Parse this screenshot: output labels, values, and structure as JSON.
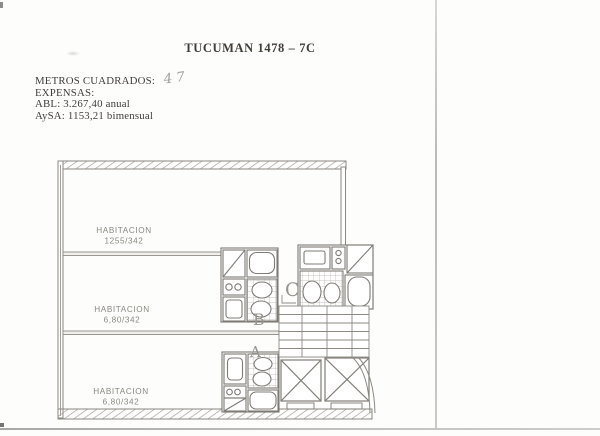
{
  "document": {
    "title": "TUCUMAN 1478 – 7C",
    "details": {
      "metros_label": "METROS CUADRADOS:",
      "metros_value_handwritten": "47",
      "expensas_label": "EXPENSAS:",
      "abl_line": "ABL: 3.267,40 anual",
      "aysa_line": "AySA: 1153,21 bimensual"
    }
  },
  "floorplan": {
    "rooms": [
      {
        "name": "HABITACION",
        "dims": "1255/342"
      },
      {
        "name": "HABITACION",
        "dims": "6,80/342"
      },
      {
        "name": "HABITACION",
        "dims": "6,80/342"
      }
    ],
    "units": [
      "C",
      "B",
      "A"
    ]
  },
  "colors": {
    "line": "#7e7b75",
    "wall_hatch": "#a09d98",
    "room_label": "#8a8880",
    "unit_letter": "#97948e",
    "body_text": "#413e39",
    "page_edge": "#c6c6c4"
  }
}
